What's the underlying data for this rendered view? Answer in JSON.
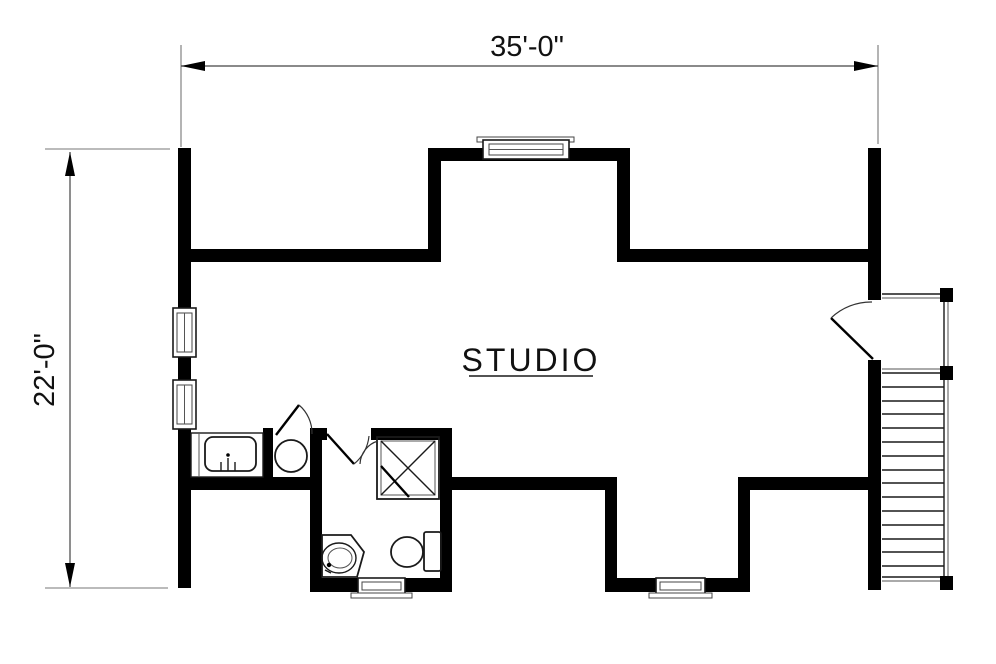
{
  "page": {
    "background": "#ffffff",
    "line_color": "#000000",
    "annotation_color": "#1a1a1a"
  },
  "plan": {
    "room_label": "STUDIO",
    "dim_width": "35'-0\"",
    "dim_height": "22'-0\"",
    "fixtures": [
      "kitchen-counter-sink",
      "water-heater",
      "bathroom-shower-stall",
      "corner-vanity-sink",
      "toilet",
      "double-hung-window",
      "dormer-window",
      "entry-door",
      "interior-door",
      "staircase-with-landing"
    ]
  }
}
